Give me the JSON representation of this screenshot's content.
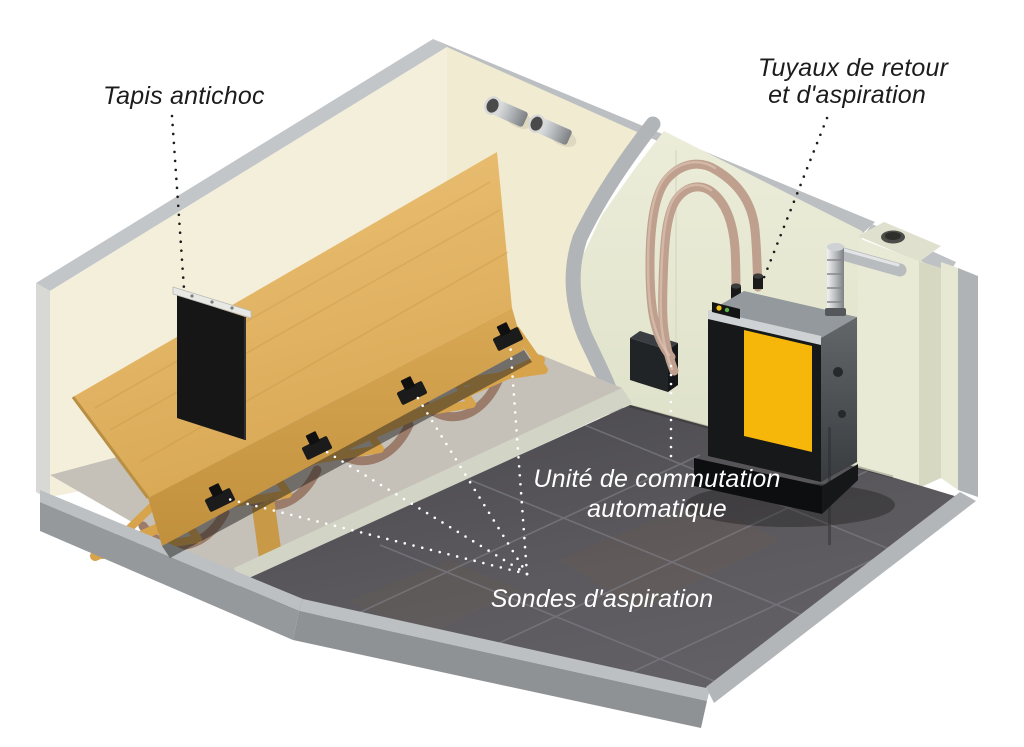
{
  "figure": {
    "type": "technical-illustration",
    "subject": "Cutaway 3D view of a wood-pellet storage room with sloped floor, suction probes and pellet boiler"
  },
  "labels": {
    "tapis_antichoc": {
      "text": "Tapis antichoc"
    },
    "tuyaux": {
      "line1": "Tuyaux de retour",
      "line2": "et d'aspiration"
    },
    "unite": {
      "line1": "Unité de commutation",
      "line2": "automatique"
    },
    "sondes": {
      "text": "Sondes d'aspiration"
    }
  },
  "colors": {
    "label_dark": "#1c1c1c",
    "label_light": "#ffffff",
    "boiler_yellow": "#f6b70a",
    "wood_top": "#e3b466",
    "wall_cream": "#f3eed9",
    "boiler_room_wall": "#e9ebd6",
    "cut_edge_gray": "#b4b8bb",
    "floor_dark": "#56555a",
    "hose_beige": "#bfa08f",
    "concrete": "#c5c1b9"
  }
}
